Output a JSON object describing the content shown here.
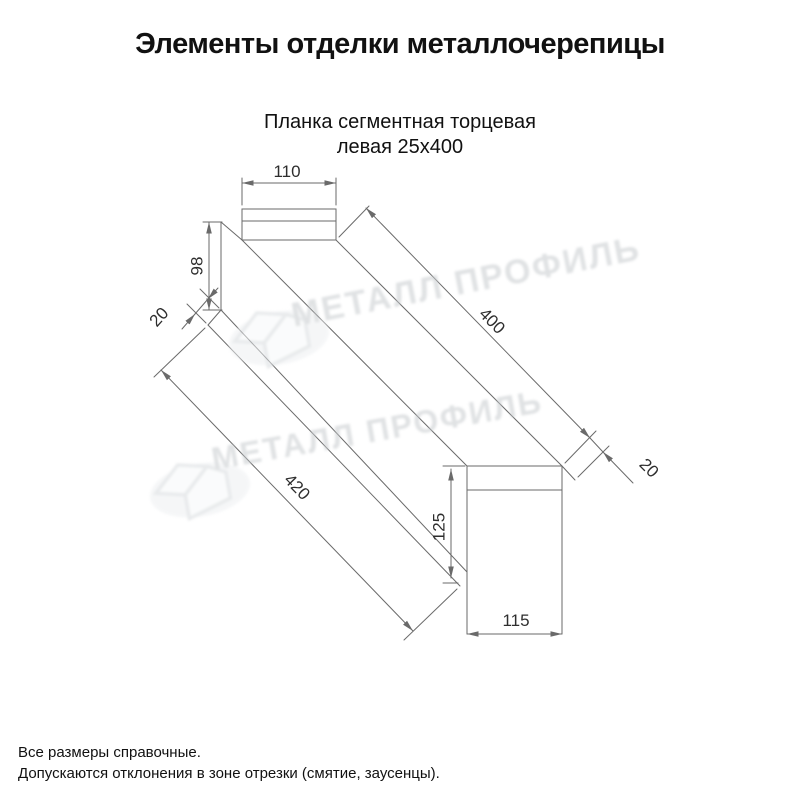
{
  "title": "Элементы отделки металлочерепицы",
  "subtitle": {
    "line1": "Планка сегментная торцевая",
    "line2": "левая 25х400"
  },
  "drawing": {
    "dimensions": {
      "top_width": "110",
      "side_height": "98",
      "top_hem": "20",
      "length_top": "400",
      "length_bottom": "420",
      "end_hem": "20",
      "end_plate_height": "125",
      "end_plate_width": "115"
    },
    "watermark": {
      "text": "МЕТАЛЛ ПРОФИЛЬ"
    }
  },
  "notes": {
    "line1": "Все размеры справочные.",
    "line2": "Допускаются отклонения в зоне отрезки (смятие, заусенцы)."
  },
  "colors": {
    "background": "#ffffff",
    "line": "#6a6a6a",
    "text": "#2e2e2e",
    "heading": "#111111",
    "watermark": "#c6cacd"
  }
}
